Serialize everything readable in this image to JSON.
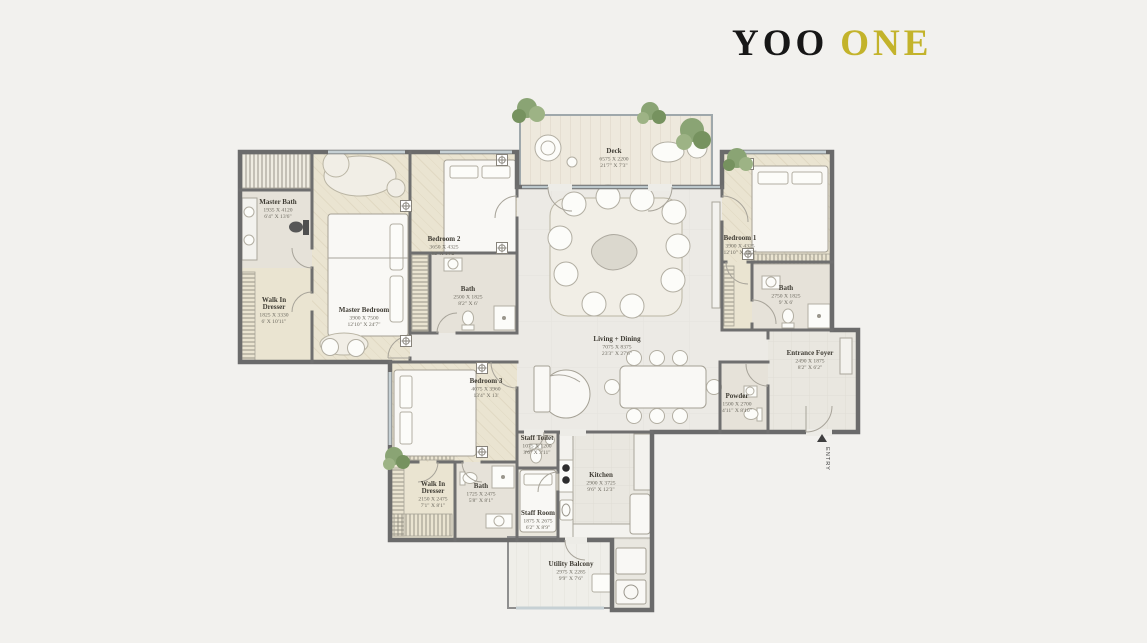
{
  "logo": {
    "part1": "YOO",
    "part2": "ONE",
    "accent_color": "#c3b32b"
  },
  "entry": {
    "label": "ENTRY"
  },
  "colors": {
    "background": "#f2f1ee",
    "wall": "#6b6b6b",
    "floor_beige": "#eae4d1",
    "floor_bath": "#e6e2d9",
    "floor_living": "#eceae5",
    "deck_wood": "#eee9dd",
    "plant_green": "#8aa474",
    "logo_gold": "#c3b32b",
    "label_text": "#403d35"
  },
  "plan": {
    "rooms": [
      {
        "id": "master-bath",
        "name": "Master Bath",
        "mm": "1935 X 4120",
        "ft": "6'4\" X 13'6\"",
        "cx": 278,
        "cy": 204
      },
      {
        "id": "walk-in-dresser-master",
        "name": "Walk In",
        "name2": "Dresser",
        "mm": "1825 X 3330",
        "ft": "6' X 10'11\"",
        "cx": 274,
        "cy": 302
      },
      {
        "id": "master-bedroom",
        "name": "Master Bedroom",
        "mm": "3900 X 7500",
        "ft": "12'10\" X 24'7\"",
        "cx": 364,
        "cy": 312
      },
      {
        "id": "bedroom-2",
        "name": "Bedroom 2",
        "mm": "3650 X 4325",
        "ft": "12' X 14'2\"",
        "cx": 444,
        "cy": 241
      },
      {
        "id": "bath-2",
        "name": "Bath",
        "mm": "2500 X 1825",
        "ft": "8'2\" X 6'",
        "cx": 468,
        "cy": 291
      },
      {
        "id": "deck",
        "name": "Deck",
        "mm": "6575 X 2200",
        "ft": "21'7\" X 7'3\"",
        "cx": 614,
        "cy": 153
      },
      {
        "id": "living-dining",
        "name": "Living + Dining",
        "mm": "7075 X 8375",
        "ft": "23'3\" X 27'6\"",
        "cx": 617,
        "cy": 341
      },
      {
        "id": "bedroom-1",
        "name": "Bedroom 1",
        "mm": "3900 X 4325",
        "ft": "12'10\" X 14'2\"",
        "cx": 740,
        "cy": 240
      },
      {
        "id": "bath-1",
        "name": "Bath",
        "mm": "2750 X 1825",
        "ft": "9' X 6'",
        "cx": 786,
        "cy": 290
      },
      {
        "id": "entrance-foyer",
        "name": "Entrance Foyer",
        "mm": "2490 X 1875",
        "ft": "8'2\" X 6'2\"",
        "cx": 810,
        "cy": 355
      },
      {
        "id": "powder",
        "name": "Powder",
        "mm": "1500 X 2700",
        "ft": "4'11\" X 8'10\"",
        "cx": 737,
        "cy": 398
      },
      {
        "id": "bedroom-3",
        "name": "Bedroom 3",
        "mm": "4075 X 3960",
        "ft": "13'4\" X 13'",
        "cx": 486,
        "cy": 383
      },
      {
        "id": "staff-toilet",
        "name": "Staff Toilet",
        "mm": "1075 X 1200",
        "ft": "3'6\" X 3'11\"",
        "cx": 537,
        "cy": 440
      },
      {
        "id": "walk-in-dresser-3",
        "name": "Walk In",
        "name2": "Dresser",
        "mm": "2150 X 2475",
        "ft": "7'1\" X 8'1\"",
        "cx": 433,
        "cy": 486
      },
      {
        "id": "bath-3",
        "name": "Bath",
        "mm": "1725 X 2475",
        "ft": "5'8\" X 8'1\"",
        "cx": 481,
        "cy": 488
      },
      {
        "id": "staff-room",
        "name": "Staff Room",
        "mm": "1875 X 2675",
        "ft": "6'2\" X 8'9\"",
        "cx": 538,
        "cy": 515
      },
      {
        "id": "kitchen",
        "name": "Kitchen",
        "mm": "2900 X 3725",
        "ft": "9'6\" X 12'3\"",
        "cx": 601,
        "cy": 477
      },
      {
        "id": "utility-balcony",
        "name": "Utility Balcony",
        "mm": "2975 X 2285",
        "ft": "9'9\" X 7'6\"",
        "cx": 571,
        "cy": 566
      }
    ]
  }
}
